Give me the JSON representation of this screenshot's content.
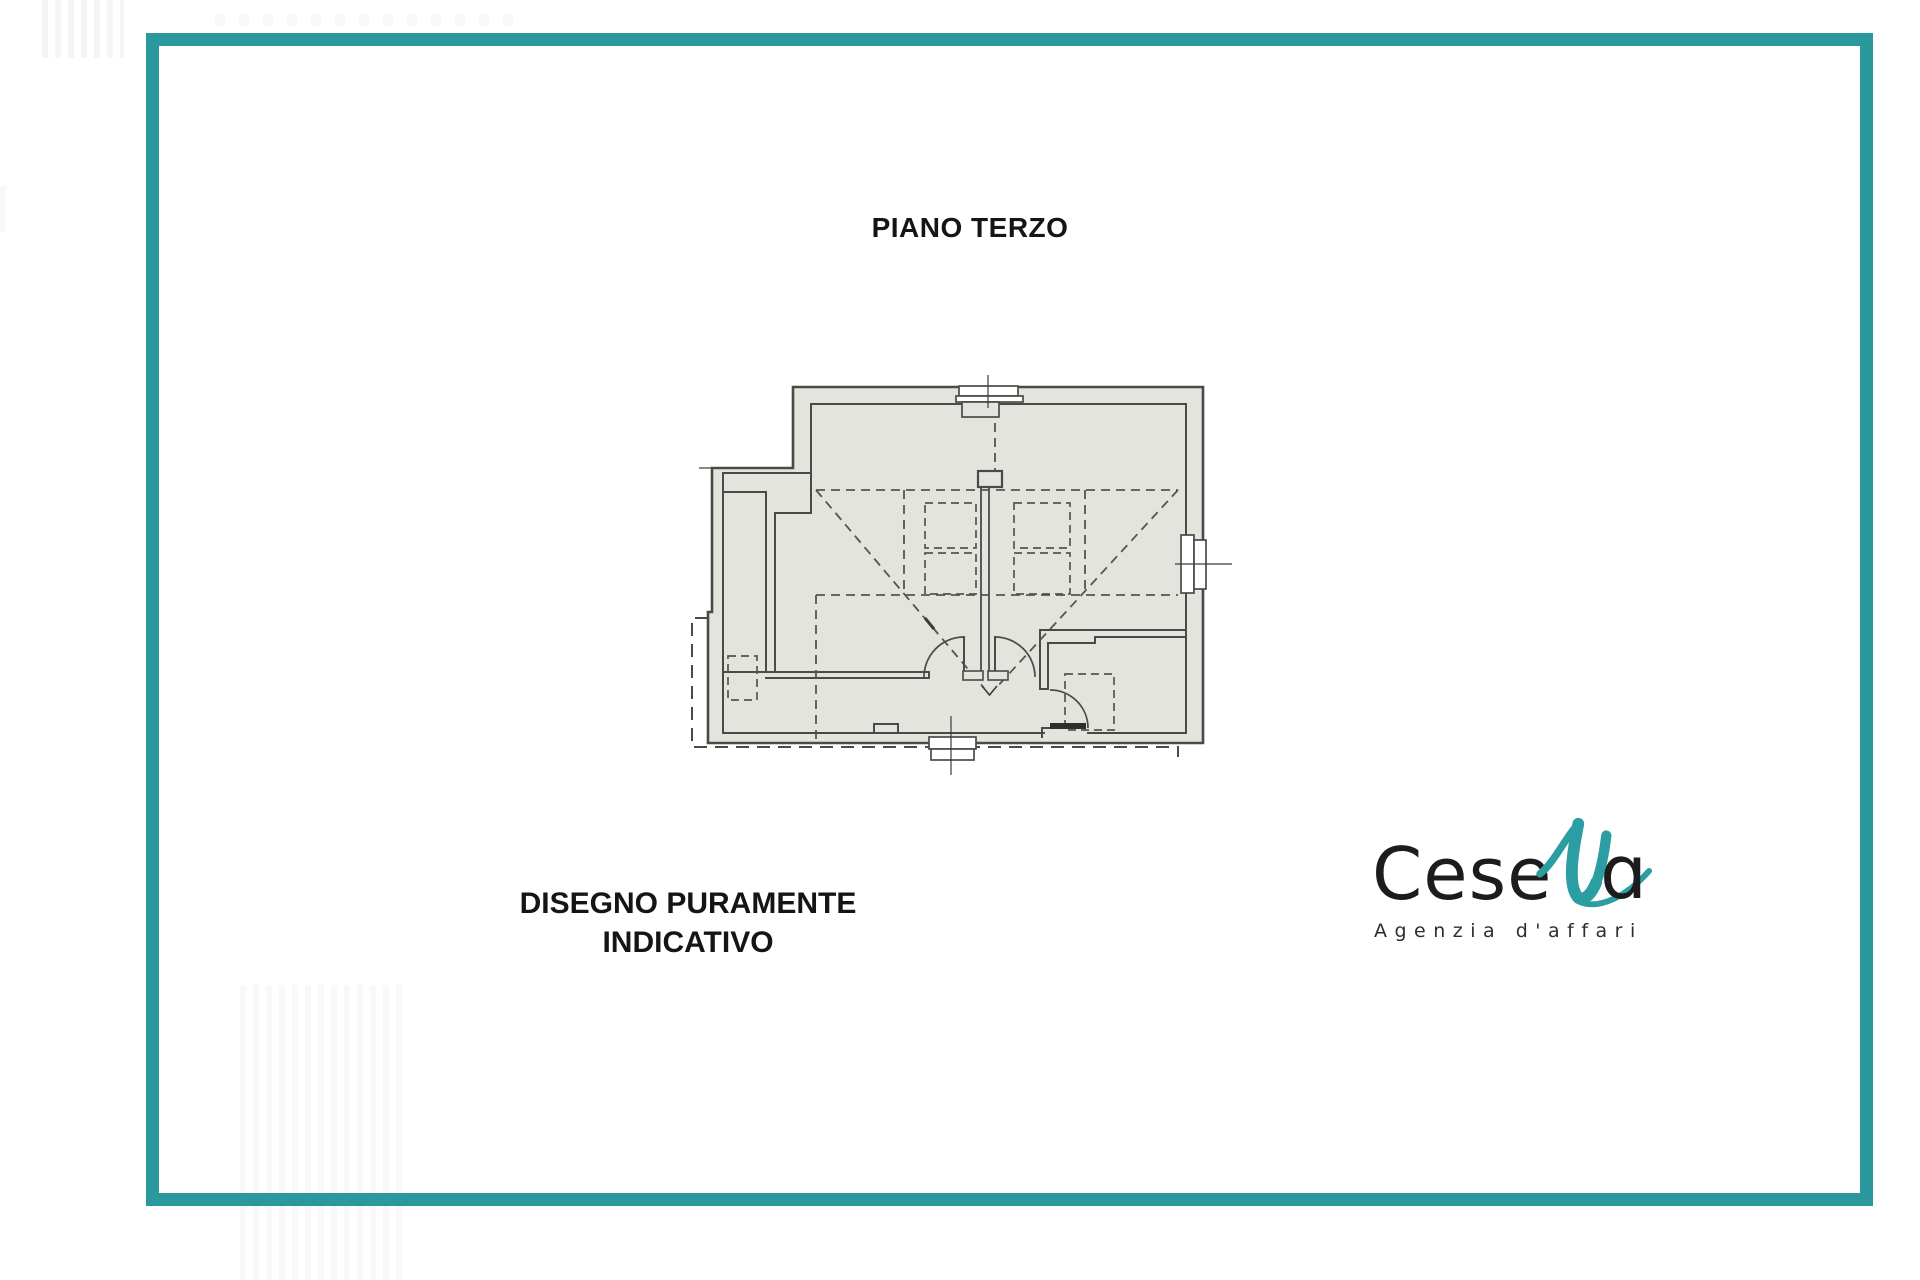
{
  "colors": {
    "frame": "#2a989d",
    "accent": "#2b9ea3",
    "line": "#4a4a46",
    "floor": "#e4e4df",
    "ink": "#1c1c1c",
    "paper": "#ffffff"
  },
  "title": "PIANO TERZO",
  "disclaimer": {
    "line1": "DISEGNO PURAMENTE",
    "line2": "INDICATIVO"
  },
  "logo": {
    "word_start": "Cese",
    "word_end": "ɑ",
    "tagline": "Agenzia d'affari"
  }
}
